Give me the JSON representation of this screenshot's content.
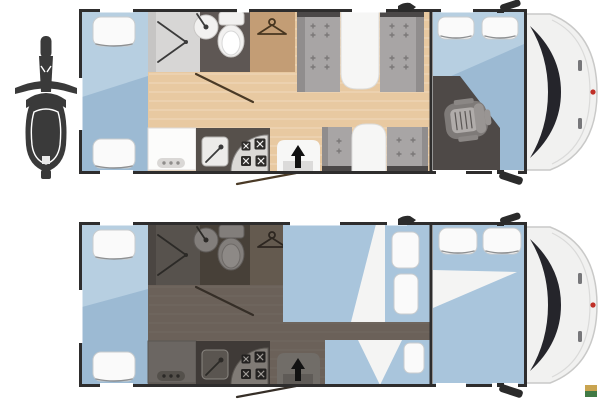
{
  "meta": {
    "description": "Motorhome floor plan diagram with day and night layouts, scooter garage icon and vehicle cab",
    "canvas": {
      "width": 600,
      "height": 400
    }
  },
  "floorplans": [
    {
      "id": "day",
      "label": "Day layout floor plan",
      "areas": [
        "rear-twin-beds",
        "shower",
        "washroom-with-toilet-and-sink",
        "wardrobe",
        "face-to-face-dinette-with-tables",
        "kitchen-with-sink-and-stove",
        "entry-door",
        "cab-with-swivel-driver-seat",
        "overcab-bed-with-pillows"
      ]
    },
    {
      "id": "night",
      "label": "Night layout floor plan (beds made up, living area dimmed)",
      "areas": [
        "rear-twin-beds",
        "converted-dinette-double-bed",
        "side-bed-with-cushions",
        "overcab-double-bed",
        "dimmed-kitchen",
        "dimmed-washroom",
        "dimmed-wardrobe",
        "dimmed-entry-door"
      ]
    }
  ],
  "icons": [
    "scooter-icon",
    "shower-door-icon",
    "sink-icon",
    "toilet-icon",
    "hanger-icon",
    "kitchen-sink-icon",
    "stove-burner-icon",
    "entry-arrow-icon",
    "driver-seat-icon",
    "side-mirror-icon",
    "roof-vent-icon",
    "brand-logo-dot",
    "watermark"
  ],
  "colors": {
    "wall": "#2e2d2d",
    "wood": "#e8c9a1",
    "bed-light": "#b7cfe1",
    "bed-dark": "#9cbad3",
    "bed": "#a9c5dc",
    "pillow": "#fafafa",
    "pillow-edge": "#c9ccce",
    "sheet": "#f4f4f3",
    "seat": "#a8a5a5",
    "seat-edge": "#908d8d",
    "seat-cap": "#4b4848",
    "plus-mark": "#7b7878",
    "table": "#f6f6f5",
    "table-edge": "#dcdcda",
    "shower": "#d7d6d5",
    "fixture-line": "#3b3b3b",
    "bath": "#5e5754",
    "porcelain": "#f2f1f0",
    "porcelain-edge": "#c9c7c5",
    "wardrobe": "#c39d75",
    "hanger": "#47351f",
    "swing": "#4a3a26",
    "counter": "#fcfcfb",
    "counter-edge": "#dbd9d7",
    "dots-pill": "#dad8d6",
    "dot": "#8f8d8b",
    "kitchen": "#56504b",
    "k-sink": "#ecebe9",
    "stove": "#dbd9d6",
    "burner": "#2e2c2a",
    "burner-x": "#f0efee",
    "door": "#f7f7f6",
    "step": "#dcdbda",
    "arrow": "#121212",
    "cab-floor": "#4e4947",
    "seat-base": "#7e7a78",
    "seat-cushion": "#b0acaa",
    "seat-back": "#999593",
    "seat-arm": "#8b8785",
    "seat-stripe": "#5a5654",
    "v-body": "#f1f1f0",
    "v-edge": "#c9c9c8",
    "v-seam": "#dadad9",
    "windshield": "#25252b",
    "v-handle": "#77777a",
    "brand-red": "#c03028",
    "mirror": "#2b2b2b",
    "scooter": "#3a3a3a",
    "night-floor": "#6b6159",
    "night-bath": "#474038",
    "night-shower": "#57524d",
    "night-wardrobe": "#645a4f",
    "night-kitchen": "#3f3a37",
    "night-counter": "#6b6662",
    "night-dots": "#54504b",
    "night-door": "#716d68",
    "night-step": "#5f5b57",
    "night-sink": "#5a5550",
    "night-stove": "#807b76",
    "night-burner": "#232120",
    "night-burner-x": "#9e9a96",
    "night-fixture": "#827e7b",
    "night-line": "#2c2a27",
    "night-swing": "#352e27",
    "wm-gold": "#c9a450",
    "wm-green": "#417a45"
  }
}
